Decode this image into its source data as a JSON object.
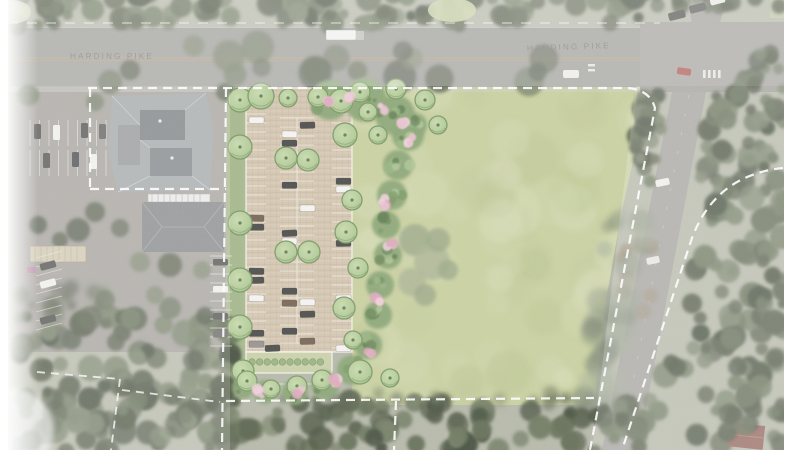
{
  "scene": {
    "description": "Aerial site plan rendering of a proposed landscaped parking lot and open lawn along Harding Pike",
    "road_labels": {
      "west": "HARDING PIKE",
      "east": "HARDING PIKE"
    }
  },
  "colors": {
    "lawn": "#c4cc97",
    "parking_paving": "#d0c0a8",
    "canopy_tree": "#abc68d",
    "canopy_tree_rim": "#6e8f55",
    "shrub_bed": "#7f9d68",
    "flower_pink": "#e4b6c7",
    "boundary_line": "#ffffff",
    "asphalt": "#8f8e89",
    "existing_roof": "#93979a",
    "woodland": "#46513a"
  },
  "features": [
    {
      "name": "harding-pike-road"
    },
    {
      "name": "side-road-intersection"
    },
    {
      "name": "property-boundary-dashed"
    },
    {
      "name": "proposed-parking-lot"
    },
    {
      "name": "landscape-planting-beds"
    },
    {
      "name": "open-lawn"
    },
    {
      "name": "existing-commercial-buildings"
    },
    {
      "name": "existing-parking-lot"
    },
    {
      "name": "woodland-areas"
    }
  ]
}
